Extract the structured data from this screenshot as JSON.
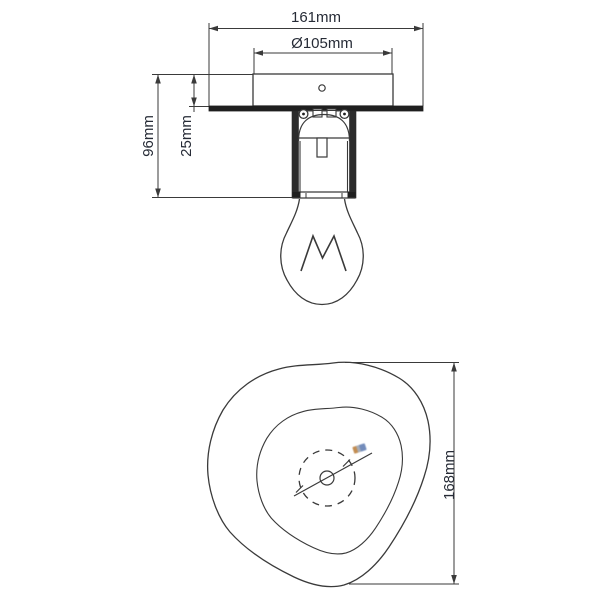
{
  "drawing": {
    "title": "ceiling-light-dimension-drawing",
    "colors": {
      "background": "#ffffff",
      "line": "#3a3a3a",
      "fill_dark": "#1f1f1f",
      "text": "#262b36",
      "micro_label_colors": [
        "#b97a35",
        "#5b79b0"
      ]
    },
    "side_view": {
      "labels": {
        "overall_width": "161mm",
        "canopy_diameter": "Ø105mm",
        "overall_height": "96mm",
        "canopy_height": "25mm"
      },
      "parts": [
        "shade-plate",
        "canopy",
        "lamp-socket",
        "bulb",
        "filament-mark"
      ]
    },
    "bottom_view": {
      "labels": {
        "shade_height": "168mm"
      },
      "parts": [
        "shade-outline",
        "inner-ring",
        "hub-dashed-circle",
        "center-hole",
        "hub-diameter-line"
      ]
    }
  }
}
